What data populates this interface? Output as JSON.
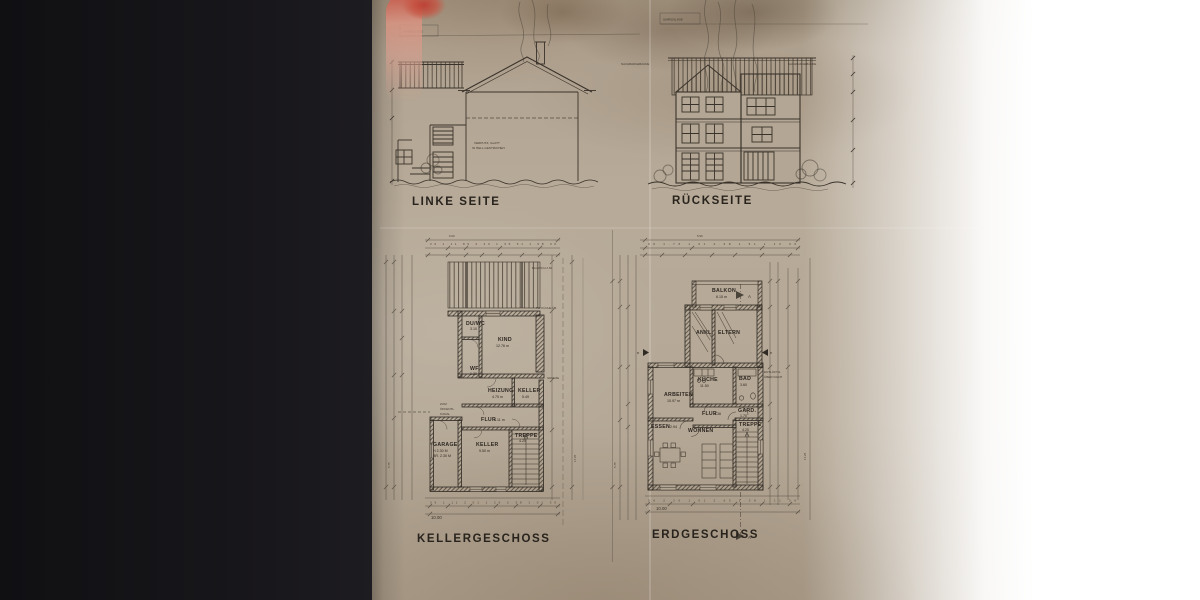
{
  "colors": {
    "background": "#17161a",
    "paper": "#b5a896",
    "ink": "#3a332b",
    "finger_red": "#bf3e32"
  },
  "header": {
    "outline_label_left": "UMRISSLINIE",
    "outline_label_right": "UMRISSLINIE",
    "neighbor_label_left": "NACHBARGEBÄUDE",
    "neighbor_label_right": "NACHBARGEBÄUDE"
  },
  "elevations": {
    "left": {
      "title": "LINKE SEITE",
      "note_line1": "VERPUTZ, GLATT",
      "note_line2": "IN HELL GESTRICHEN"
    },
    "back": {
      "title": "RÜCKSEITE"
    }
  },
  "basement": {
    "title": "KELLERGESCHOSS",
    "rooms": {
      "duwc": {
        "name": "DU/WC",
        "area": "3.10"
      },
      "kind": {
        "name": "KIND",
        "area": "12.76 m"
      },
      "wf": {
        "name": "WF",
        "area": "1.20"
      },
      "heizung": {
        "name": "HEIZUNG",
        "area": "4.75 m"
      },
      "keller_small": {
        "name": "KELLER",
        "area": "5.49"
      },
      "flur": {
        "name": "FLUR",
        "area": "4.11 m"
      },
      "keller_big": {
        "name": "KELLER",
        "area": "9.50 m"
      },
      "treppe": {
        "name": "TREPPE",
        "area": "4.25"
      },
      "garage": {
        "name": "GARAGE",
        "note1": "H 2.30 M",
        "note2": "BR. 2.30 M"
      }
    },
    "annotations": {
      "kanal1": "ZUM",
      "kanal2": "ÖFFENTL.",
      "kanal3": "KANAL",
      "grenze": "GRENZE",
      "bauwich": "BAUWICH 2.50",
      "tw": "TW KÜCHE ÜB."
    },
    "dims": {
      "overall_top": "6.00",
      "overall_bottom": "10.00",
      "top_chain": "36 1.11 89 2.23 1.35 51 1.08 36",
      "bottom_chain": "36 1.11 2.01 1.26 2.38 1.01 36",
      "left_side": "5.75",
      "right_side": "17.25"
    }
  },
  "ground": {
    "title": "ERDGESCHOSS",
    "rooms": {
      "balkon": {
        "name": "BALKON",
        "area": "6.15 m"
      },
      "ankl": {
        "name": "ANKL."
      },
      "eltern": {
        "name": "ELTERN"
      },
      "kueche": {
        "name": "KÜCHE",
        "area": "11.50"
      },
      "bad": {
        "name": "BAD",
        "area": "3.60"
      },
      "arbeiten": {
        "name": "ARBEITEN",
        "area": "10.97 m"
      },
      "flur": {
        "name": "FLUR",
        "area": "4.36"
      },
      "gard": {
        "name": "GARD.",
        "area": "1.70"
      },
      "essen": {
        "name": "ESSEN",
        "area": "12.94"
      },
      "wohnen": {
        "name": "WOHNEN"
      },
      "treppe": {
        "name": "TREPPE",
        "area": "4.20"
      }
    },
    "annotations": {
      "vent1": "ENTLÜFTG.",
      "vent2": "ÜBER DACH",
      "section_a": "A",
      "section_b": "B"
    },
    "dims": {
      "overall_top": "5.90",
      "overall_bottom": "10.00",
      "top_chain": "36 1.76 1.01 2.38 1.51 1.12 36",
      "bottom_chain": "36 2.26 1.01 2.63 1.38 1.11 36",
      "left_side": "5.75",
      "right_side": "17.25"
    }
  }
}
